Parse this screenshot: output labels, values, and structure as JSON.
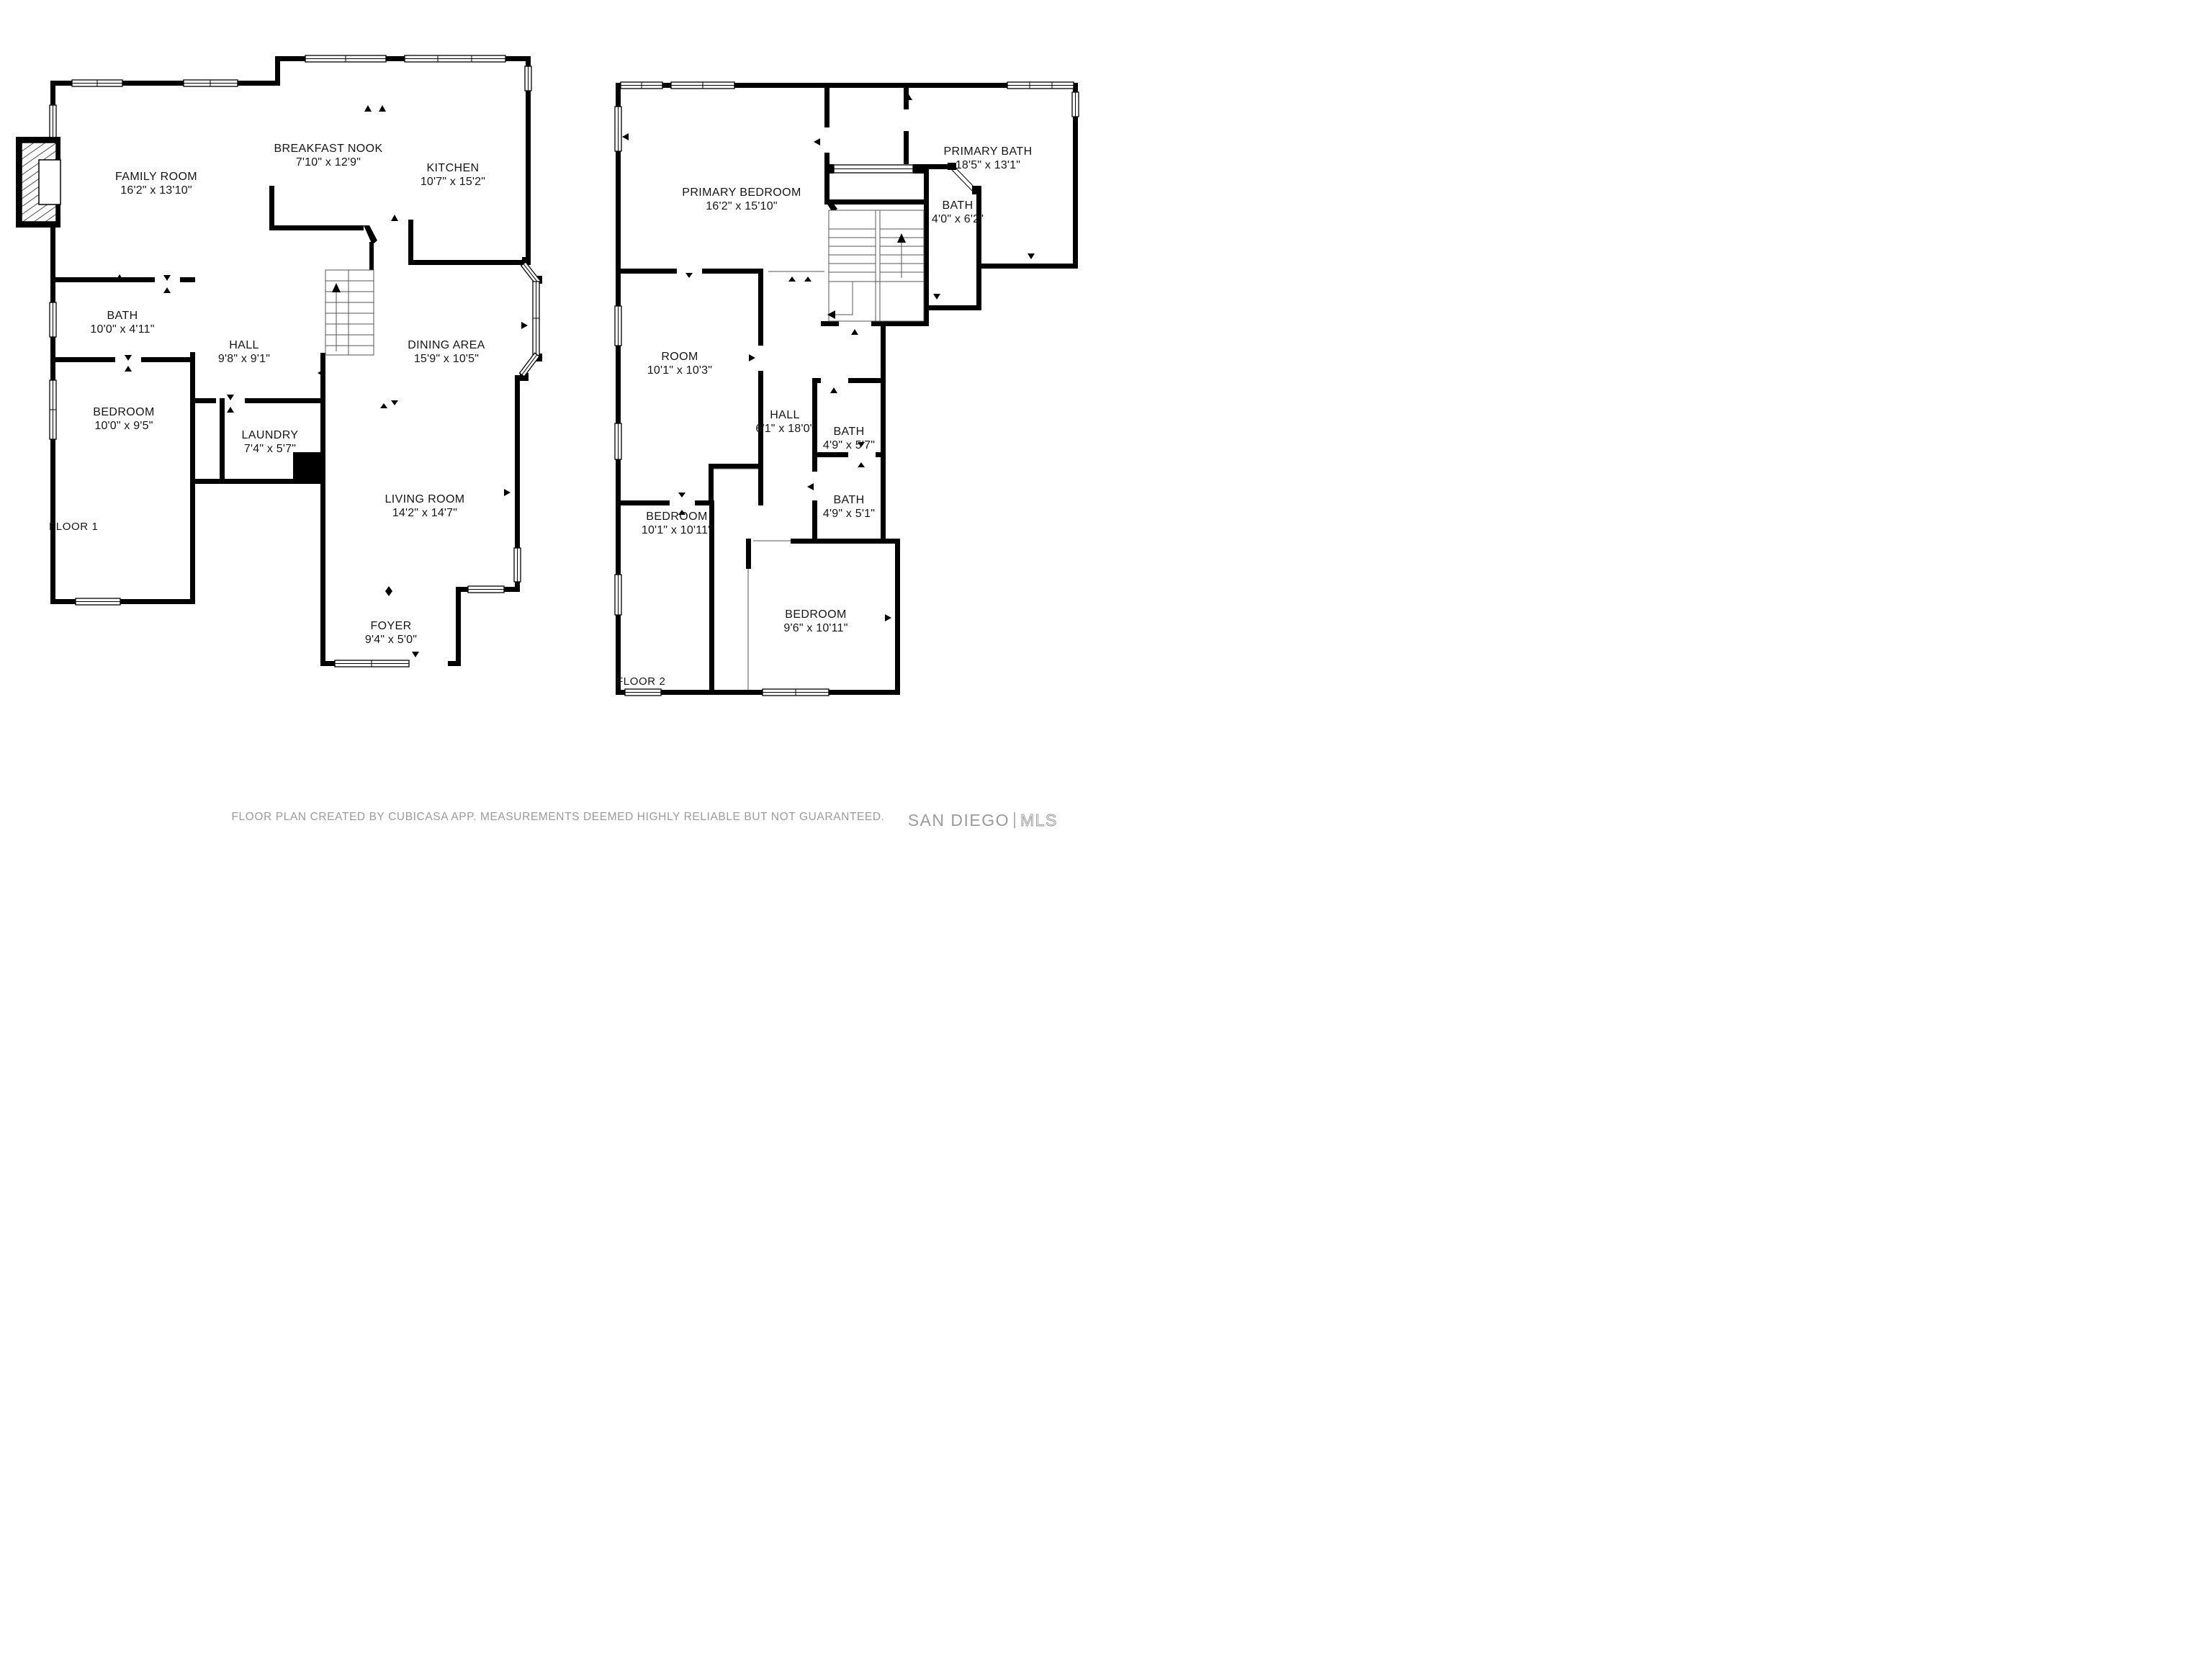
{
  "document_type": "floor-plan",
  "floor1": {
    "label": "FLOOR 1",
    "rooms": {
      "family": {
        "name": "FAMILY ROOM",
        "dims": "16'2\" x 13'10\""
      },
      "nook": {
        "name": "BREAKFAST NOOK",
        "dims": "7'10\" x 12'9\""
      },
      "kitchen": {
        "name": "KITCHEN",
        "dims": "10'7\" x 15'2\""
      },
      "bath": {
        "name": "BATH",
        "dims": "10'0\" x 4'11\""
      },
      "hall": {
        "name": "HALL",
        "dims": "9'8\" x 9'1\""
      },
      "dining": {
        "name": "DINING AREA",
        "dims": "15'9\" x 10'5\""
      },
      "bedroom": {
        "name": "BEDROOM",
        "dims": "10'0\" x 9'5\""
      },
      "laundry": {
        "name": "LAUNDRY",
        "dims": "7'4\" x 5'7\""
      },
      "living": {
        "name": "LIVING ROOM",
        "dims": "14'2\" x 14'7\""
      },
      "foyer": {
        "name": "FOYER",
        "dims": "9'4\" x 5'0\""
      }
    }
  },
  "floor2": {
    "label": "FLOOR 2",
    "rooms": {
      "primary_bedroom": {
        "name": "PRIMARY BEDROOM",
        "dims": "16'2\" x 15'10\""
      },
      "primary_bath": {
        "name": "PRIMARY BATH",
        "dims": "18'5\" x 13'1\""
      },
      "bath_small": {
        "name": "BATH",
        "dims": "4'0\" x 6'2\""
      },
      "room": {
        "name": "ROOM",
        "dims": "10'1\" x 10'3\""
      },
      "hall": {
        "name": "HALL",
        "dims": "6'1\" x 18'0\""
      },
      "bath_upper": {
        "name": "BATH",
        "dims": "4'9\" x 5'7\""
      },
      "bath_lower": {
        "name": "BATH",
        "dims": "4'9\" x 5'1\""
      },
      "bedroom_left": {
        "name": "BEDROOM",
        "dims": "10'1\" x 10'11\""
      },
      "bedroom_right": {
        "name": "BEDROOM",
        "dims": "9'6\" x 10'11\""
      }
    }
  },
  "footer": {
    "disclaimer": "FLOOR PLAN CREATED BY CUBICASA APP. MEASUREMENTS DEEMED HIGHLY RELIABLE BUT NOT GUARANTEED."
  },
  "watermark": {
    "brand": "SAN DIEGO",
    "suffix": "MLS"
  },
  "colors": {
    "wall": "#000000",
    "background": "#ffffff",
    "label": "#151515",
    "muted": "#9b9b9b"
  }
}
